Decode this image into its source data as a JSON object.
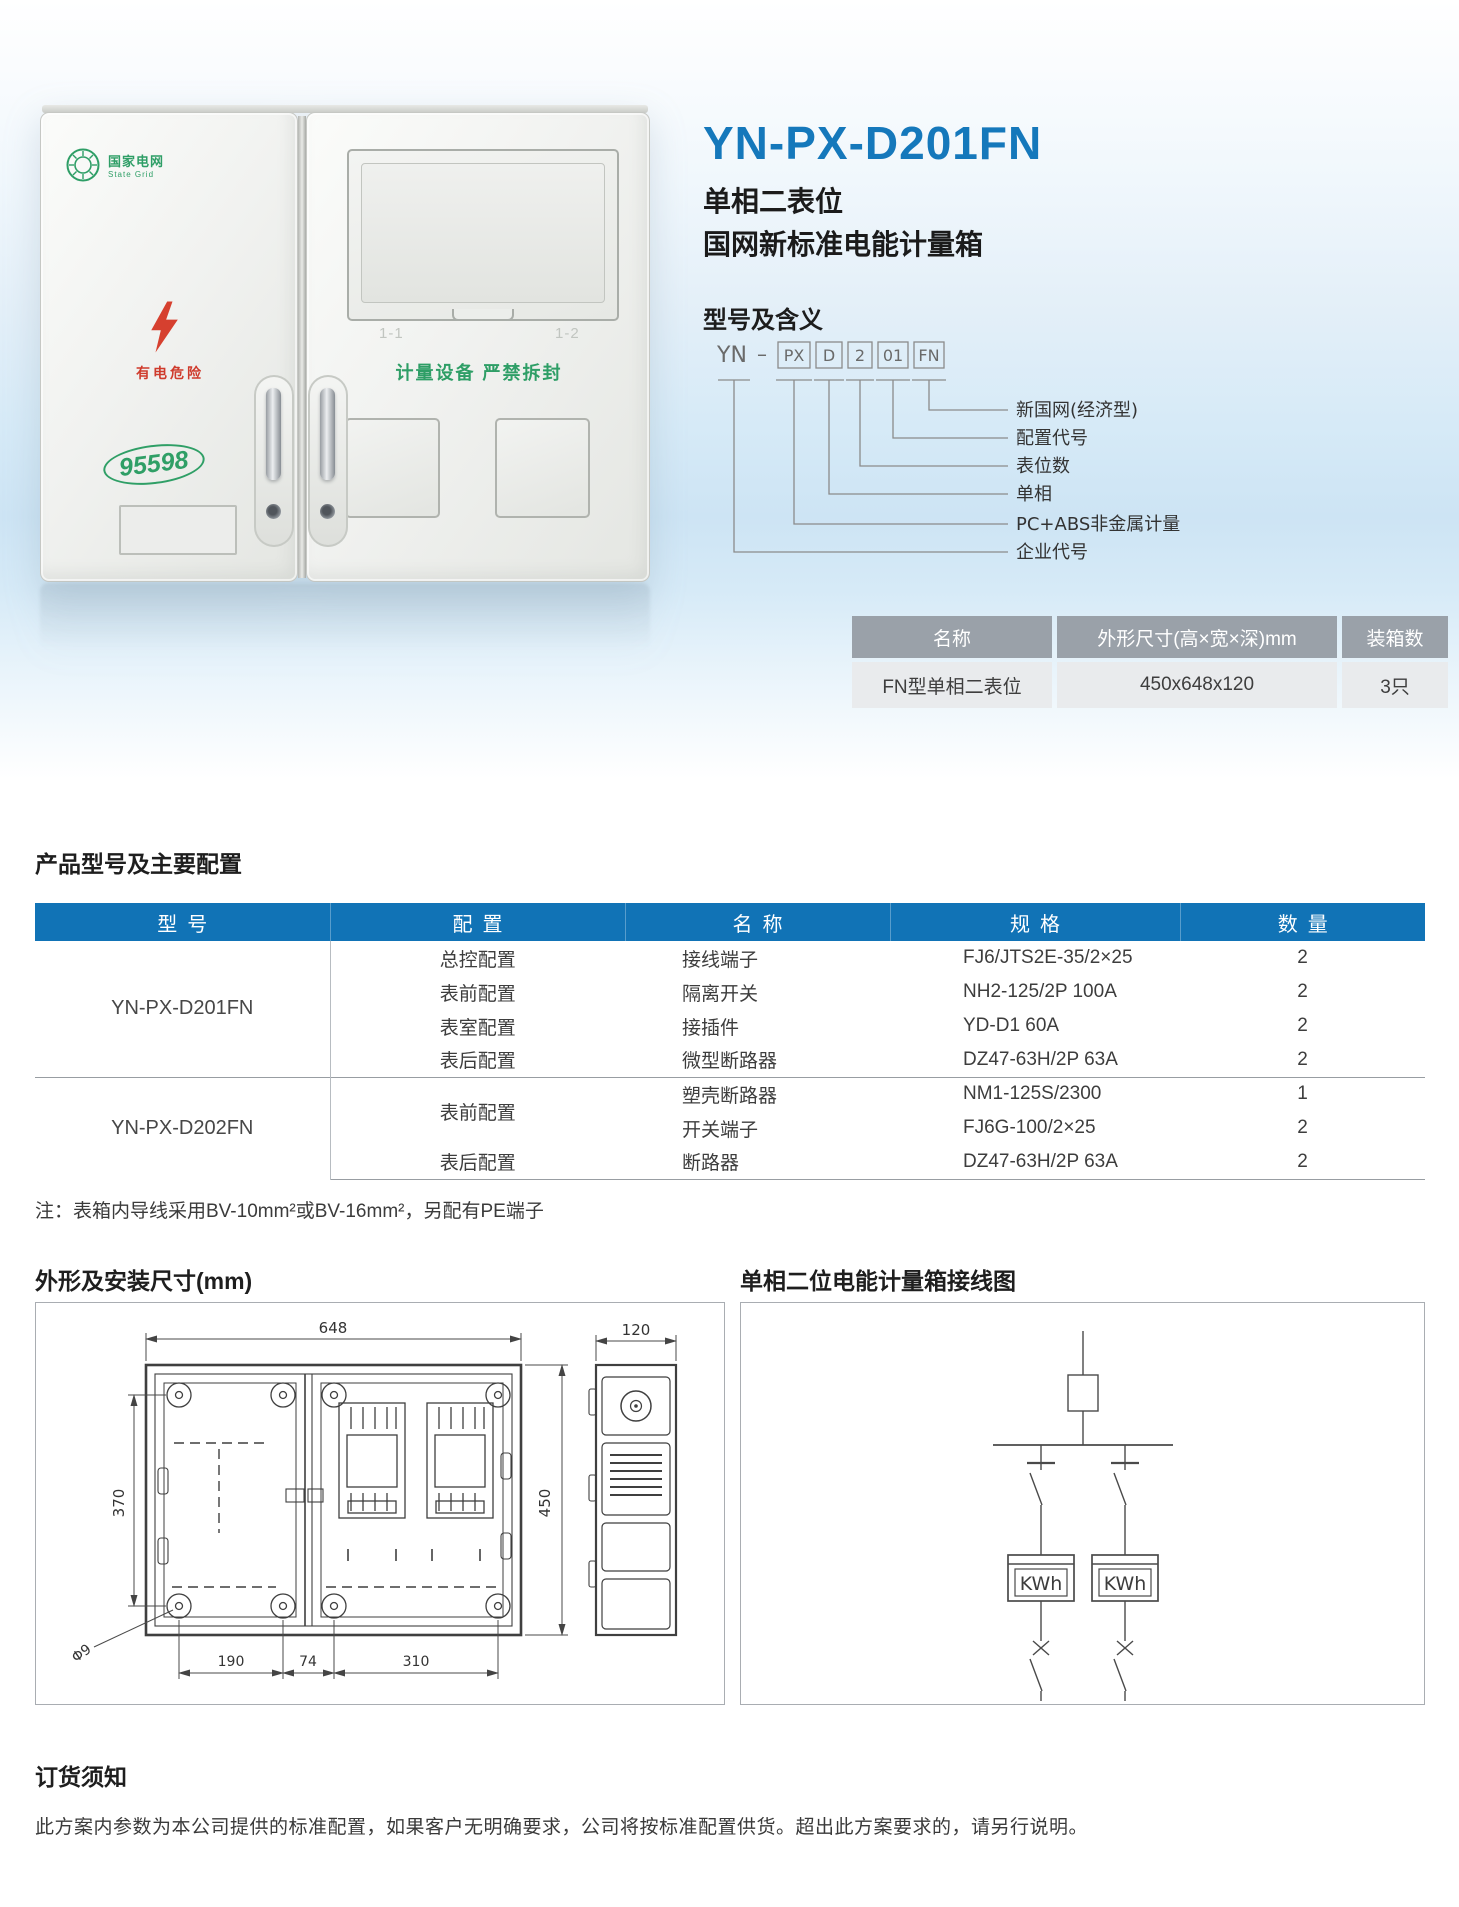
{
  "hero": {
    "title": "YN-PX-D201FN",
    "subtitle1": "单相二表位",
    "subtitle2": "国网新标准电能计量箱"
  },
  "photo": {
    "logo_title": "国家电网",
    "logo_subtitle": "State Grid",
    "danger_label": "有电危险",
    "hotline": "95598",
    "door_label_left": "1-1",
    "door_label_right": "1-2",
    "seal_label": "计量设备 严禁拆封"
  },
  "model_meaning": {
    "heading": "型号及含义",
    "prefix": "YN",
    "dash": "–",
    "codes": [
      "PX",
      "D",
      "2",
      "01",
      "FN"
    ],
    "labels": [
      "新国网(经济型)",
      "配置代号",
      "表位数",
      "单相",
      "PC+ABS非金属计量箱",
      "企业代号"
    ]
  },
  "spec_table": {
    "headers": [
      "名称",
      "外形尺寸(高×宽×深)mm",
      "装箱数"
    ],
    "row": [
      "FN型单相二表位",
      "450x648x120",
      "3只"
    ]
  },
  "config": {
    "heading": "产品型号及主要配置",
    "headers": [
      "型号",
      "配置",
      "名称",
      "规格",
      "数量"
    ],
    "groups": [
      {
        "model": "YN-PX-D201FN",
        "rows": [
          {
            "config": "总控配置",
            "name": "接线端子",
            "spec": "FJ6/JTS2E-35/2×25",
            "qty": "2"
          },
          {
            "config": "表前配置",
            "name": "隔离开关",
            "spec": "NH2-125/2P 100A",
            "qty": "2"
          },
          {
            "config": "表室配置",
            "name": "接插件",
            "spec": "YD-D1 60A",
            "qty": "2"
          },
          {
            "config": "表后配置",
            "name": "微型断路器",
            "spec": "DZ47-63H/2P 63A",
            "qty": "2"
          }
        ]
      },
      {
        "model": "YN-PX-D202FN",
        "rows": [
          {
            "config": "表前配置",
            "name": "塑壳断路器",
            "spec": "NM1-125S/2300",
            "qty": "1"
          },
          {
            "name": "开关端子",
            "spec": "FJ6G-100/2×25",
            "qty": "2"
          },
          {
            "config": "表后配置",
            "name": "断路器",
            "spec": "DZ47-63H/2P 63A",
            "qty": "2"
          }
        ]
      }
    ],
    "note": "注：表箱内导线采用BV-10mm²或BV-16mm²，另配有PE端子"
  },
  "dimensions": {
    "heading": "外形及安装尺寸(mm)",
    "width": "648",
    "height": "450",
    "depth": "120",
    "mount_vertical": "370",
    "bottom_left": "190",
    "bottom_middle": "74",
    "bottom_right": "310",
    "hole_diameter": "Φ9"
  },
  "wiring": {
    "heading": "单相二位电能计量箱接线图",
    "meter_label": "KWh"
  },
  "order": {
    "heading": "订货须知",
    "text": "此方案内参数为本公司提供的标准配置，如果客户无明确要求，公司将按标准配置供货。超出此方案要求的，请另行说明。"
  }
}
